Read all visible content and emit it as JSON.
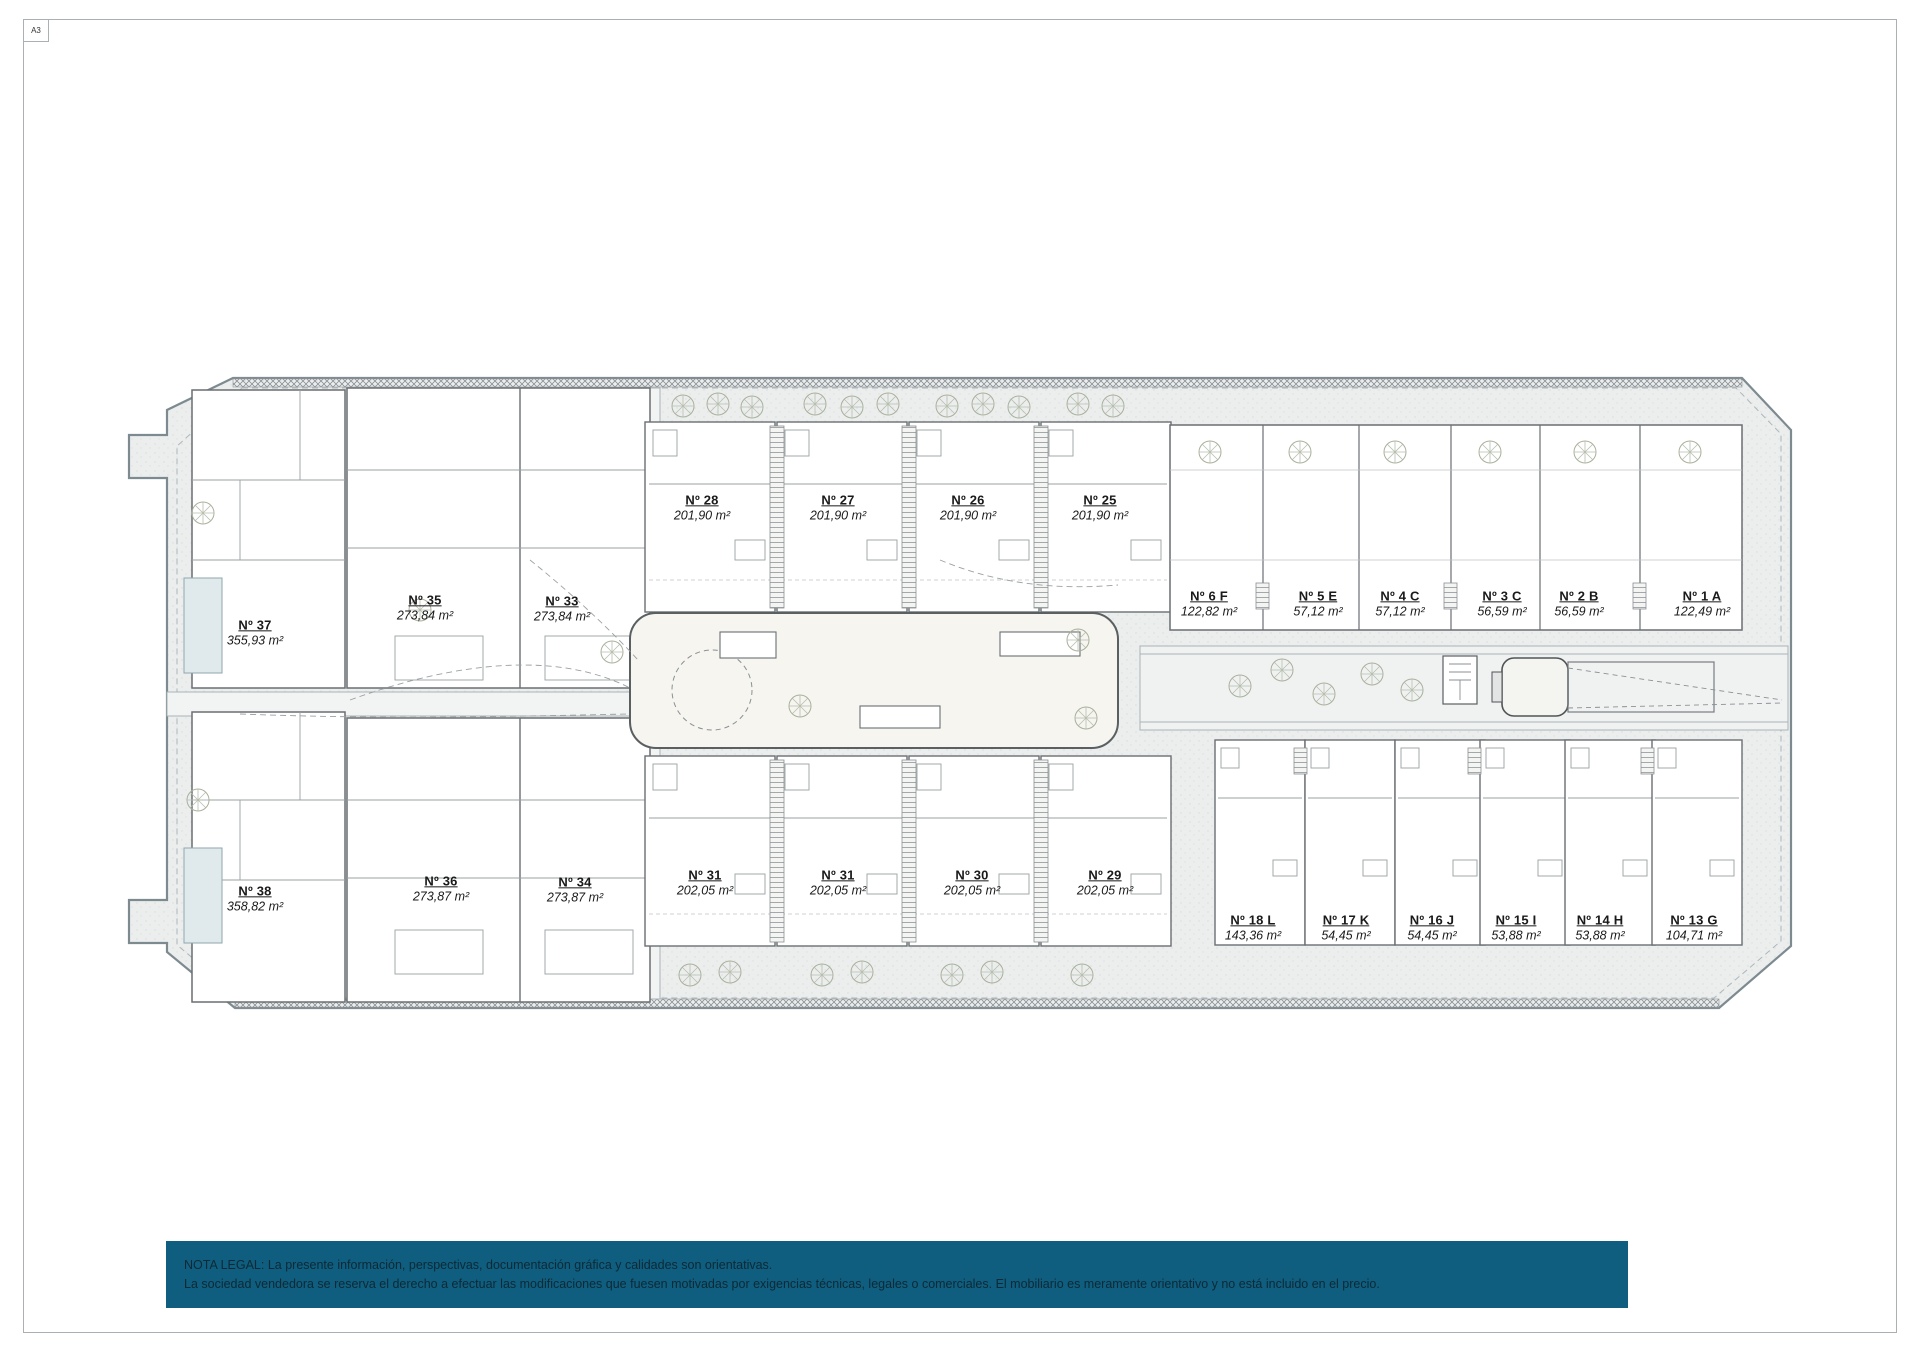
{
  "sheet": {
    "format_label": "A3"
  },
  "legal_note": {
    "line1": "NOTA LEGAL: La presente información, perspectivas, documentación gráfica y calidades son orientativas.",
    "line2": "La sociedad vendedora se reserva el derecho a efectuar las modificaciones que fuesen motivadas por exigencias técnicas, legales o comerciales. El mobiliario es meramente orientativo y no está incluido en el precio."
  },
  "colors": {
    "legal_bar_bg": "#0f5e7f",
    "legal_text": "#0d2935",
    "site_fill": "#eceeee",
    "site_outline": "#7d8b91",
    "building_fill": "#ffffff",
    "building_outline": "#6a6f72",
    "courtyard_fill": "#f6f5f0"
  },
  "plan": {
    "units": [
      {
        "number": "Nº 37",
        "area": "355,93 m²",
        "x": 255,
        "y": 633
      },
      {
        "number": "Nº 38",
        "area": "358,82 m²",
        "x": 255,
        "y": 899
      },
      {
        "number": "Nº 35",
        "area": "273,84 m²",
        "x": 425,
        "y": 608
      },
      {
        "number": "Nº 33",
        "area": "273,84 m²",
        "x": 562,
        "y": 609
      },
      {
        "number": "Nº 36",
        "area": "273,87 m²",
        "x": 441,
        "y": 889
      },
      {
        "number": "Nº 34",
        "area": "273,87 m²",
        "x": 575,
        "y": 890
      },
      {
        "number": "Nº 28",
        "area": "201,90 m²",
        "x": 702,
        "y": 508
      },
      {
        "number": "Nº 27",
        "area": "201,90 m²",
        "x": 838,
        "y": 508
      },
      {
        "number": "Nº 26",
        "area": "201,90 m²",
        "x": 968,
        "y": 508
      },
      {
        "number": "Nº 25",
        "area": "201,90 m²",
        "x": 1100,
        "y": 508
      },
      {
        "number": "Nº 31",
        "area": "202,05 m²",
        "x": 705,
        "y": 883
      },
      {
        "number": "Nº 31",
        "area": "202,05 m²",
        "x": 838,
        "y": 883
      },
      {
        "number": "Nº 30",
        "area": "202,05 m²",
        "x": 972,
        "y": 883
      },
      {
        "number": "Nº 29",
        "area": "202,05 m²",
        "x": 1105,
        "y": 883
      },
      {
        "number": "Nº 6 F",
        "area": "122,82 m²",
        "x": 1209,
        "y": 604
      },
      {
        "number": "Nº 5 E",
        "area": "57,12 m²",
        "x": 1318,
        "y": 604
      },
      {
        "number": "Nº 4 C",
        "area": "57,12 m²",
        "x": 1400,
        "y": 604
      },
      {
        "number": "Nº 3 C",
        "area": "56,59 m²",
        "x": 1502,
        "y": 604
      },
      {
        "number": "Nº 2 B",
        "area": "56,59 m²",
        "x": 1579,
        "y": 604
      },
      {
        "number": "Nº 1 A",
        "area": "122,49 m²",
        "x": 1702,
        "y": 604
      },
      {
        "number": "Nº 18 L",
        "area": "143,36 m²",
        "x": 1253,
        "y": 928
      },
      {
        "number": "Nº 17 K",
        "area": "54,45 m²",
        "x": 1346,
        "y": 928
      },
      {
        "number": "Nº 16 J",
        "area": "54,45 m²",
        "x": 1432,
        "y": 928
      },
      {
        "number": "Nº 15 I",
        "area": "53,88 m²",
        "x": 1516,
        "y": 928
      },
      {
        "number": "Nº 14 H",
        "area": "53,88 m²",
        "x": 1600,
        "y": 928
      },
      {
        "number": "Nº 13 G",
        "area": "104,71 m²",
        "x": 1694,
        "y": 928
      }
    ]
  }
}
